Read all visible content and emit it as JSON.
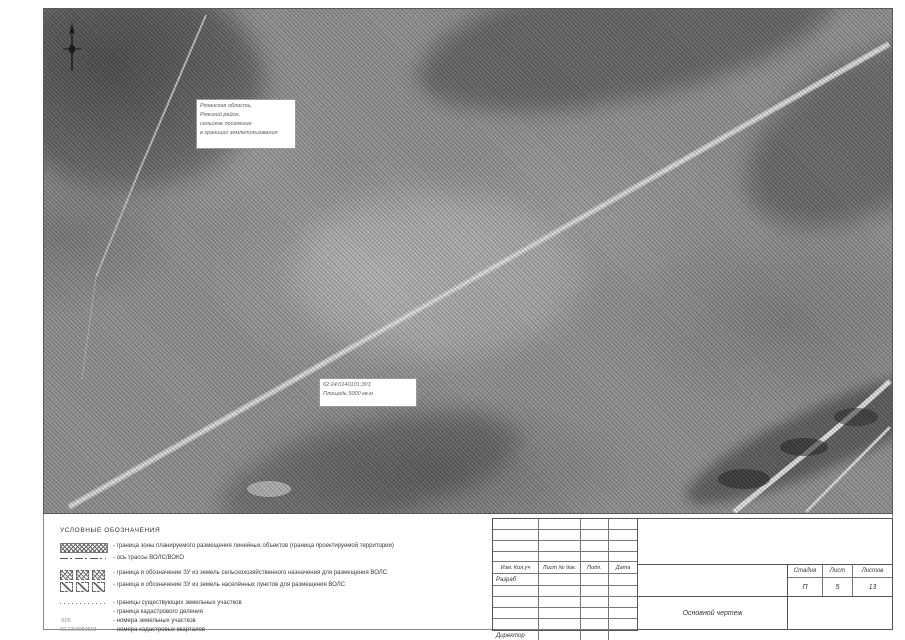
{
  "map": {
    "location_label": {
      "line1": "Рязанская область,",
      "line2": "Ряжский район,",
      "line3": "сельское поселение",
      "line4": "в границах землепользования"
    },
    "parcel_label": {
      "cadastral_number": "62:24:0140101:ЗУ1",
      "area": "Площадь 5000 кв.м"
    }
  },
  "legend": {
    "title": "УСЛОВНЫЕ ОБОЗНАЧЕНИЯ",
    "items": [
      {
        "symbol": "zone-hatch-swatch",
        "text": "- граница зоны планируемого размещения линейных объектов (граница проектируемой территории)"
      },
      {
        "symbol": "axis-dash-dot-line",
        "text": "- ось трассы ВОЛС/ВОКО"
      },
      {
        "symbol": "agricultural-parcel-boxes",
        "text": "- граница и обозначение ЗУ из земель сельскохозяйственного назначения для размещения ВОЛС"
      },
      {
        "symbol": "settlement-parcel-boxes",
        "text": "- граница и обозначение ЗУ из земель населённых пунктов для размещения ВОЛС"
      },
      {
        "symbol": "dotted-line",
        "text": "- границы существующих земельных участков"
      },
      {
        "symbol": "none",
        "text": "- граница кадастрового деления"
      },
      {
        "symbol_text": ":505",
        "text": "- номера земельных участков"
      },
      {
        "symbol_text": "50:23:0050501",
        "text": "- номера кадастровых кварталов"
      }
    ]
  },
  "titleblock": {
    "cols": {
      "c1": "Изм.  Кол.уч",
      "c2": "Лист  № док.",
      "c3": "Подп.",
      "c4": "Дата"
    },
    "razrab": "Разраб",
    "director": "Директор",
    "doc_title": "Основной чертеж",
    "stage_label": "Стадия",
    "sheet_label": "Лист",
    "sheets_label": "Листов",
    "stage_value": "П",
    "sheet_value": "5",
    "sheets_value": "13"
  }
}
